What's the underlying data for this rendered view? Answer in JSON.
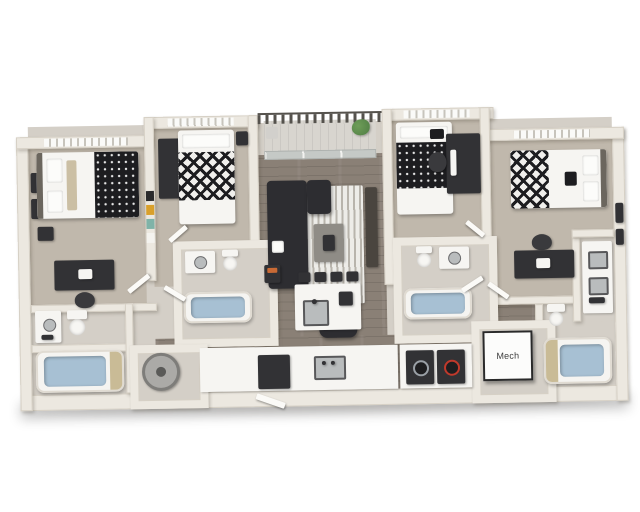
{
  "labels": {
    "mech_room": "Mech"
  },
  "scene": {
    "background": "#ffffff",
    "rooms": [
      "bedroom-1",
      "bedroom-2",
      "bedroom-3",
      "bedroom-4",
      "living-room",
      "kitchen",
      "balcony",
      "bathroom-left",
      "bathroom-center-left",
      "bathroom-center-right",
      "bathroom-right",
      "laundry-closet",
      "water-heater-closet",
      "mech-room"
    ],
    "fixtures": [
      "bed",
      "desk",
      "desk-chair",
      "wall-art",
      "kitchen-island",
      "bar-stools",
      "sofa",
      "area-rug",
      "coffee-table",
      "accent-chair",
      "media-console",
      "bathtub",
      "toilet",
      "vanity-sink",
      "washer",
      "dryer",
      "water-heater",
      "refrigerator-dishwasher",
      "balcony-railing",
      "potted-plant",
      "sliding-glass-door"
    ]
  },
  "colors": {
    "bg": "#ffffff",
    "wall": "#ece8e0",
    "wall_edge": "#d6d0c5",
    "carpet": "#c0b8ac",
    "wood": "#8a8076",
    "bath_floor": "#d4cfc7",
    "balcony_floor": "#d8d5cf",
    "dark_furniture": "#323235",
    "sofa": "#2d2d31",
    "bedding_white": "#f6f5f2",
    "bedding_black": "#1d1d20",
    "pillow_tan": "#cbbfa4",
    "water": "#a7c0d3",
    "rug": "#edece8",
    "rug_stripe": "#b8b4ac",
    "plant": "#4f7d44",
    "railing": "#55524d",
    "accent_orange": "#c96a35",
    "accent_red": "#c0392b",
    "poster_yellow": "#d9a02b",
    "poster_teal": "#7fb3a8",
    "steel": "#b9bcbd",
    "curtain_tan": "#c9bb96"
  }
}
